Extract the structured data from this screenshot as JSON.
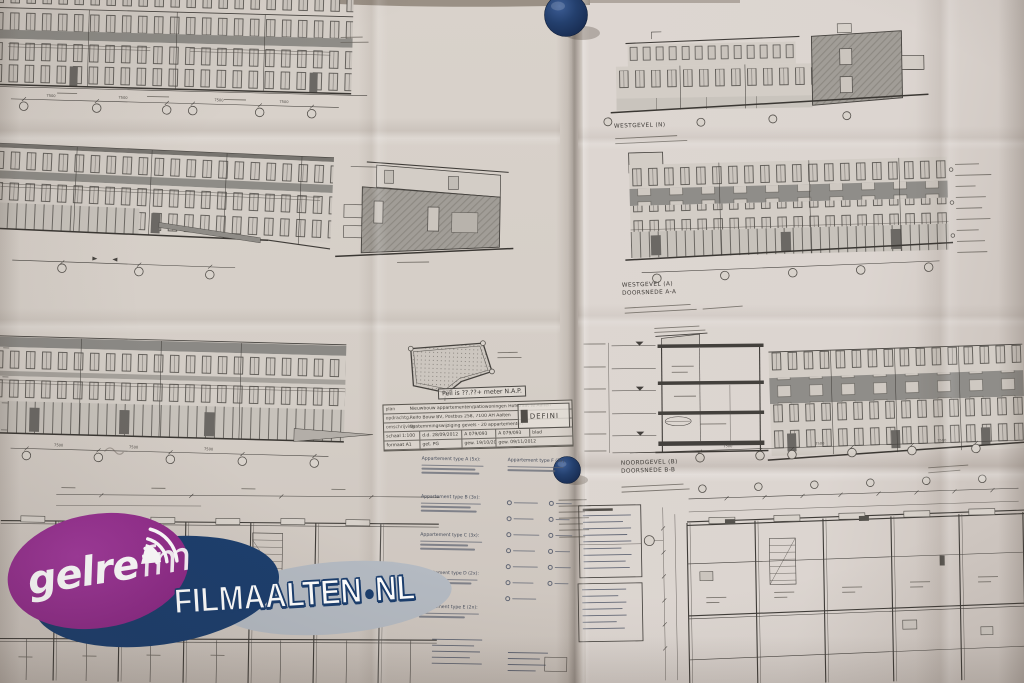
{
  "labels": {
    "westgevel_top": "WESTGEVEL (N)",
    "westgevel_mid": "WESTGEVEL (A)",
    "doorsnede_a": "DOORSNEDE A-A",
    "noordgevel": "NOORDGEVEL (B)",
    "doorsnede_b": "DOORSNEDE B-B",
    "peil_note": "Peil is ??.??+ meter N.A.P.",
    "dim_label": "7500"
  },
  "title_block": {
    "rows": [
      {
        "label": "plan",
        "value": "Nieuwbouw appartementen/patiowoningen Hofstraat te Aalten"
      },
      {
        "label": "opdrachtg.",
        "value": "Reifo Bouw BV, Postbus 258, 7100 AH Aalten"
      },
      {
        "label": "omschrijving",
        "value": "Bestemmingswijziging gevels - 20 appartementen"
      }
    ],
    "meta_row1": [
      "schaal 1:100",
      "d.d. 28/09/2012",
      "A 079/093",
      "A 079/093",
      "blad"
    ],
    "meta_row2": [
      "formaat A1",
      "get. PG",
      "gew. 19/10/2012",
      "gew. 09/11/2012"
    ],
    "stamp": "DEFINI"
  },
  "legend": {
    "items": [
      {
        "label": "Appartement type A (5x):"
      },
      {
        "label": "Appartement type B (3x):"
      },
      {
        "label": "Appartement type C (3x):"
      },
      {
        "label": "Appartement type D (2x):"
      },
      {
        "label": "Appartement type E (2x):"
      }
    ],
    "right_item": "Appartement type F (2x):"
  },
  "watermark": {
    "station_name": "gelre",
    "station_suffix": "fm",
    "site_name": "FILMAALTEN",
    "site_tld": "NL",
    "colors": {
      "purple": "#922d8e",
      "navy": "#1c3e6d",
      "silver": "#b4bac2"
    }
  },
  "pins": {
    "color": "#24406e",
    "count": 2
  }
}
